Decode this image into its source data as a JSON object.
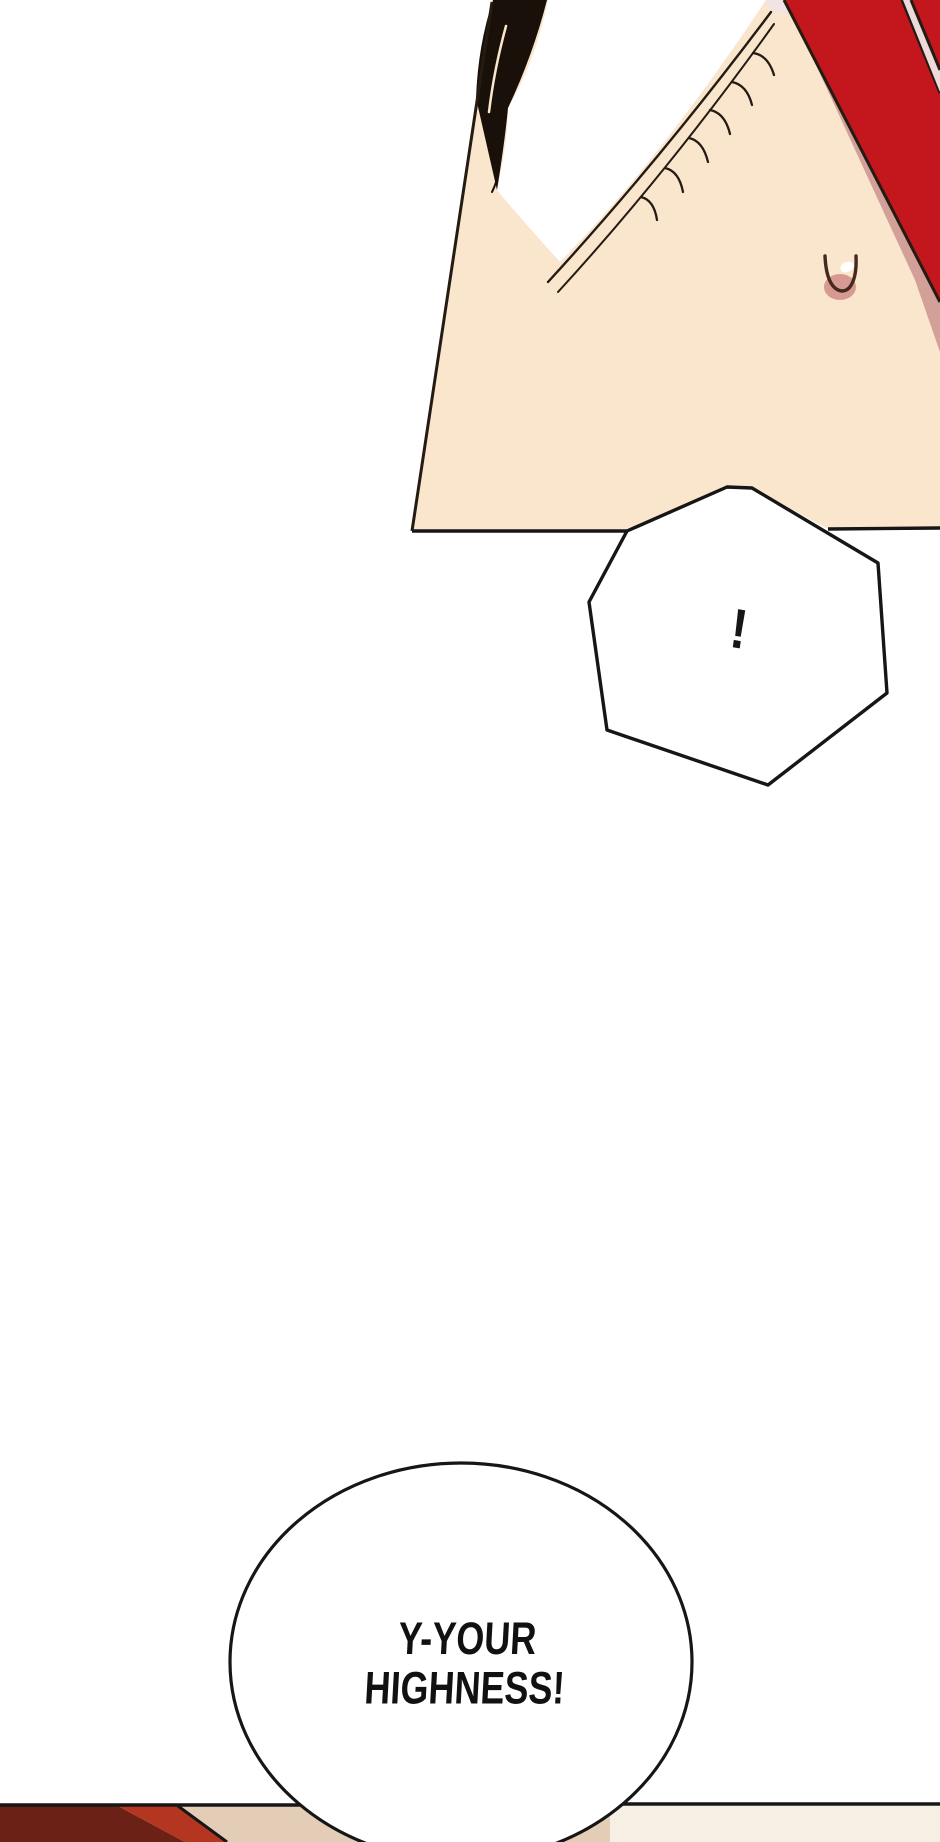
{
  "page": {
    "width": 940,
    "height": 1842,
    "background": "#ffffff"
  },
  "colors": {
    "skin": "#fae5cd",
    "skin_shadow": "#d2a099",
    "ribbon_red": "#c4171d",
    "ribbon_gap": "#eedadb",
    "eye_corner": "#f2e4e6",
    "eye_white": "#ffffff",
    "hair_black": "#1a100a",
    "line_ink": "#241b13",
    "panel_ink": "#161616",
    "nostril_pink": "#d69a92",
    "nostril_ink": "#45281f",
    "highlight_white": "#ffffff",
    "bubble_fill": "#ffffff",
    "lower_hair_maroon": "#6c2117",
    "lower_hair_red": "#b43520",
    "lower_skin_beige": "#e3cdb6",
    "lower_floor_cream": "#f6efe3"
  },
  "bubbles": {
    "exclaim": {
      "text": "!"
    },
    "shout": {
      "line1": "Y-YOUR",
      "line2": "HIGHNESS!"
    }
  }
}
